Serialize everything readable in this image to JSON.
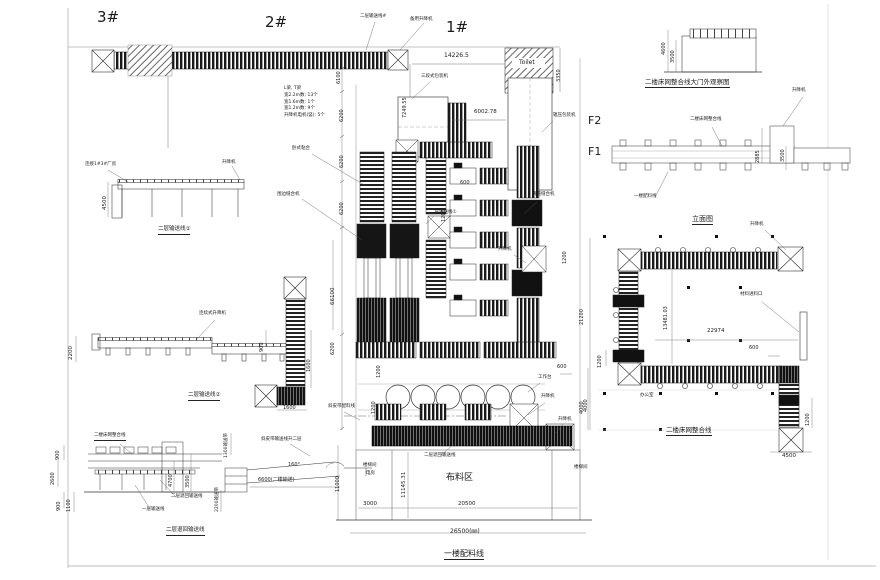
{
  "markers": {
    "b3": "3#",
    "b2": "2#",
    "b1": "1#",
    "f2": "F2",
    "f1": "F1"
  },
  "top_line": {
    "label": "二层输送线#",
    "backup_lift": "备用升降机",
    "note": [
      "L梁, T梁",
      "宽2.2m数: 13个",
      "宽1.6m数: 1个",
      "宽1.2m数: 9个",
      "升降机电机(竖): 5个"
    ]
  },
  "dims_left": {
    "d6100": "6100",
    "d6200a": "6200",
    "d6200b": "6200",
    "d6200c": "6200",
    "d66100": "66100",
    "d6200d": "6200",
    "d11000": "11000"
  },
  "top_center": {
    "d14226": "14226.5",
    "d7249": "7249.55",
    "toilet": "Toilet",
    "d3350": "3350",
    "packer": "三段式包装机",
    "d6002": "6002.78",
    "roll_packer": "辊压包装机"
  },
  "plant": {
    "horizontal_bonding": "卧式粘合",
    "edge_sewing": "围边缝合机",
    "slide_sewing": "滑道缝合机",
    "l2_conveyor": "二层输送线①",
    "d600a": "600",
    "d1200a": "1200",
    "lift1": "升降机",
    "d1200b": "1200",
    "workbench": "工作台",
    "lift2": "升降机",
    "lift3": "升降机",
    "d4000": "4000",
    "d600b": "600",
    "d1200c": "1200",
    "d1200d": "1200",
    "belt_feed": "斜皮带配料线",
    "return_line": "二层退回输送线",
    "stair1": "楼梯间",
    "power_room": "电房",
    "d11145": "11145.31",
    "fabric_area": "布料区",
    "stair2": "楼梯间",
    "d3000": "3000",
    "d20500": "20500",
    "d26500": "26500(㎜)",
    "title": "一楼配料线"
  },
  "elev1": {
    "link": "连接1#3#厂房",
    "lift": "升降机",
    "d4500": "4500",
    "title": "二层输送线①"
  },
  "elev2": {
    "lift": "连续式升降机",
    "d2200": "2200",
    "d900": "900",
    "title": "二层输送线②",
    "d1600v": "1600",
    "d1600h": "1600"
  },
  "section": {
    "top_label": "二楼床网整合线",
    "d900a": "900",
    "d2600": "2600",
    "d900b": "900",
    "d1100": "1100",
    "d4700": "4700",
    "d3500": "3500",
    "return_line": "二层退回输送线",
    "l1_line": "一层输送线",
    "title": "二层退回输送线"
  },
  "ramp": {
    "d1300": "1300输送带",
    "label": "斜皮带输送线升二层",
    "angle": "160°",
    "d6600": "6600(二楼输送)",
    "d2200": "2200输送带"
  },
  "gate": {
    "d4600": "4600",
    "d3500": "3500",
    "title": "二楼床网整合线大门外观察图"
  },
  "elevation": {
    "lift": "升降机",
    "l2_label": "二楼床网整合线",
    "l1_label": "一楼配料线",
    "d2885": "2885",
    "d3500": "3500",
    "title": "立面图"
  },
  "plan2": {
    "lift": "升降机",
    "inlet": "材料进料口",
    "d13481": "13481.03",
    "d22974": "22974",
    "d600": "600",
    "d21200": "21200",
    "d1200l": "1200",
    "d4000": "4000",
    "office": "办公室",
    "title": "二楼床网整合线",
    "d1200r": "1200",
    "d4500": "4500"
  }
}
